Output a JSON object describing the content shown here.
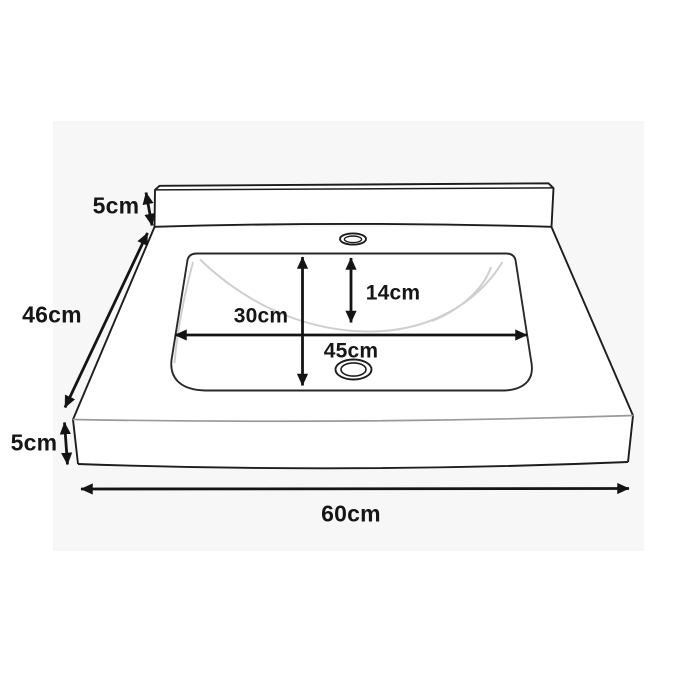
{
  "diagram": {
    "subject": "Rectangular washbasin with backsplash - dimension drawing",
    "dimensions": {
      "backsplash_height": "5cm",
      "overall_depth": "46cm",
      "slab_thickness": "5cm",
      "overall_width": "60cm",
      "bowl_front_to_back": "30cm",
      "bowl_depth_vertical": "14cm",
      "bowl_width": "45cm"
    },
    "colors": {
      "outline": "#1d1d1d",
      "dimension_lines": "#141414",
      "bowl_contour": "#cfcfcf",
      "apron_top_edge": "#9a9a9a",
      "canvas_background": "#f7f7f7",
      "page_background": "#ffffff"
    }
  }
}
